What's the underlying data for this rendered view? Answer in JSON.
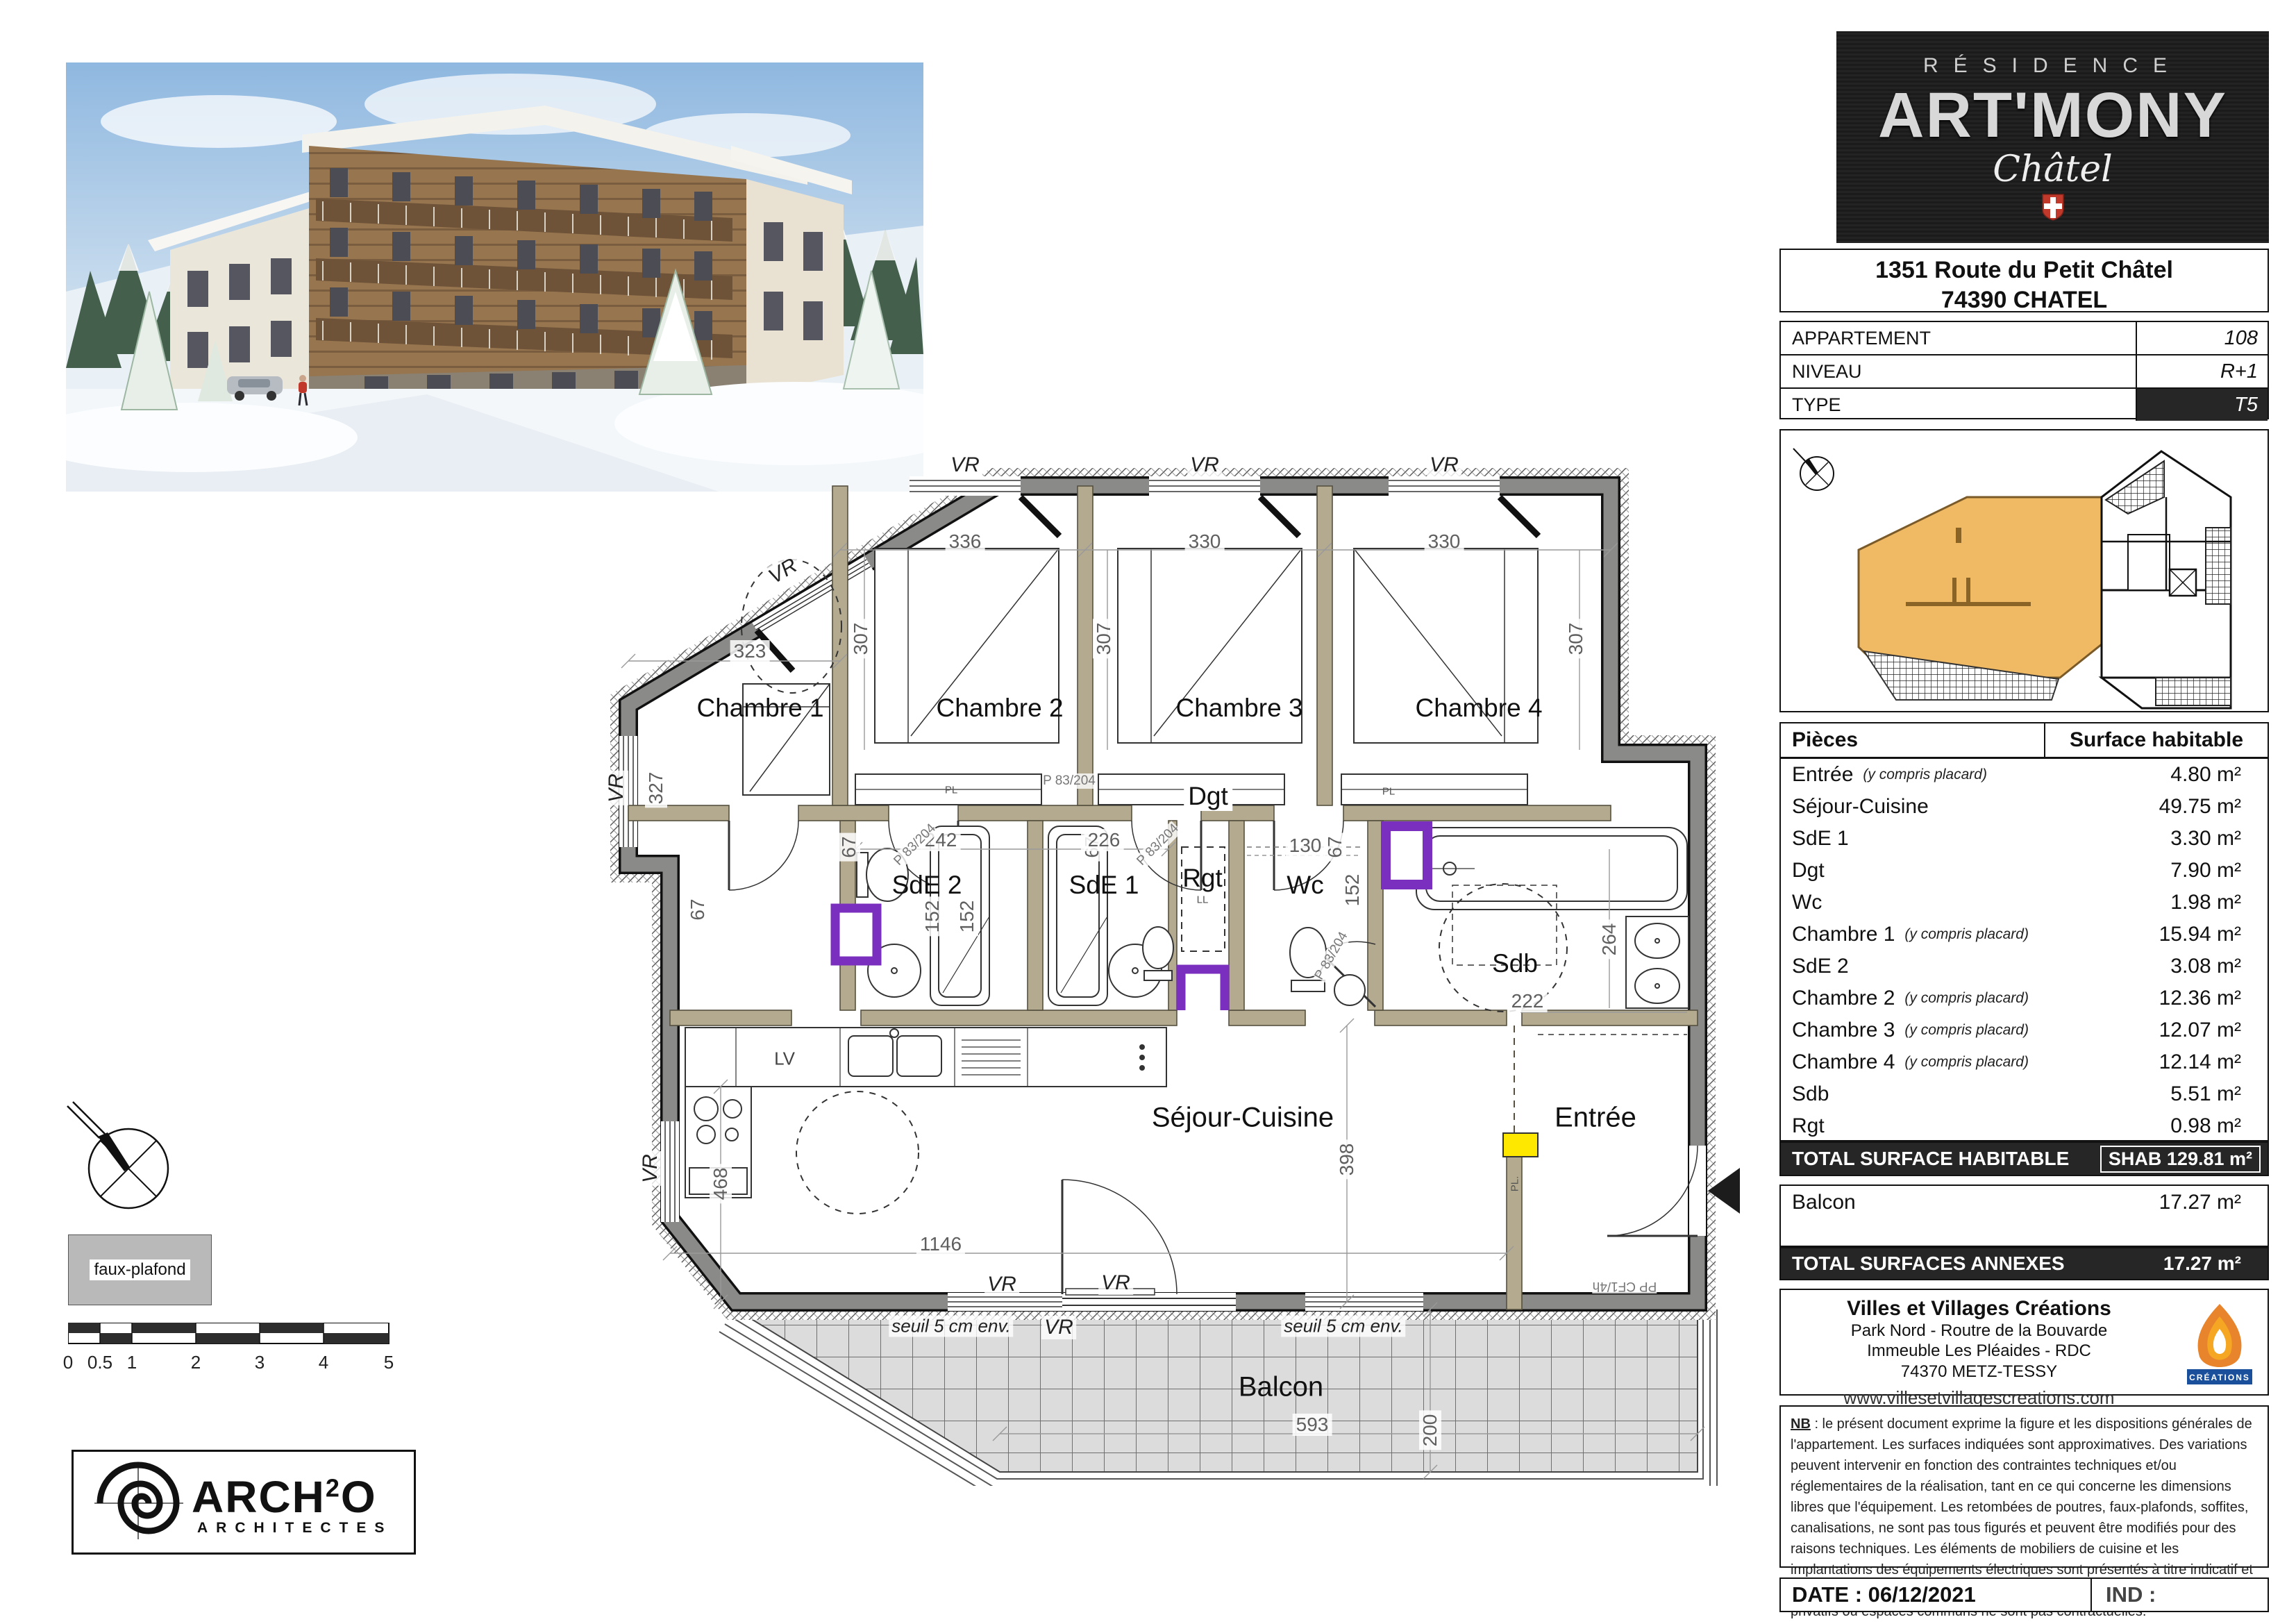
{
  "logo": {
    "residence": "RÉSIDENCE",
    "name": "ART'MONY",
    "place": "Châtel"
  },
  "address": {
    "line1": "1351 Route du Petit Châtel",
    "line2": "74390 CHATEL"
  },
  "info": {
    "rows": [
      {
        "label": "APPARTEMENT",
        "value": "108"
      },
      {
        "label": "NIVEAU",
        "value": "R+1"
      },
      {
        "label": "TYPE",
        "value": "T5"
      }
    ]
  },
  "surfaces": {
    "header": {
      "pieces": "Pièces",
      "surface": "Surface habitable"
    },
    "rows": [
      {
        "name": "Entrée",
        "note": "(y compris placard)",
        "value": "4.80 m²"
      },
      {
        "name": "Séjour-Cuisine",
        "note": "",
        "value": "49.75 m²"
      },
      {
        "name": "SdE 1",
        "note": "",
        "value": "3.30 m²"
      },
      {
        "name": "Dgt",
        "note": "",
        "value": "7.90 m²"
      },
      {
        "name": "Wc",
        "note": "",
        "value": "1.98 m²"
      },
      {
        "name": "Chambre 1",
        "note": "(y compris placard)",
        "value": "15.94 m²"
      },
      {
        "name": "SdE 2",
        "note": "",
        "value": "3.08 m²"
      },
      {
        "name": "Chambre 2",
        "note": "(y compris placard)",
        "value": "12.36 m²"
      },
      {
        "name": "Chambre 3",
        "note": "(y compris placard)",
        "value": "12.07 m²"
      },
      {
        "name": "Chambre 4",
        "note": "(y compris placard)",
        "value": "12.14 m²"
      },
      {
        "name": "Sdb",
        "note": "",
        "value": "5.51 m²"
      },
      {
        "name": "Rgt",
        "note": "",
        "value": "0.98 m²"
      }
    ],
    "total_label": "TOTAL SURFACE HABITABLE",
    "total_value": "SHAB 129.81 m²",
    "annex_row": {
      "name": "Balcon",
      "value": "17.27 m²"
    },
    "annex_total_label": "TOTAL SURFACES ANNEXES",
    "annex_total_value": "17.27 m²"
  },
  "company": {
    "name": "Villes et Villages Créations",
    "line1": "Park Nord - Routre de la Bouvarde",
    "line2": "Immeuble Les Pléaides - RDC",
    "line3": "74370 METZ-TESSY",
    "url": "www.villesetvillagescreations.com",
    "logo_caption": "CRÉATIONS"
  },
  "note": {
    "nb": "NB",
    "rest": " : le présent document exprime la figure et les dispositions générales de l'appartement. Les surfaces indiquées sont approximatives. Des variations peuvent intervenir en fonction des contraintes techniques et/ou réglementaires de la réalisation, tant en ce qui concerne les dimensions libres que l'équipement. Les retombées de poutres, faux-plafonds, soffites, canalisations, ne sont pas tous figurés et peuvent être modifiés pour des raisons techniques. Les éléments de mobiliers de cuisine et les implantations des équipements électriques sont présentés à titre indicatif et ne sont pas contractuels. Les éventuelles plantations dans les jardins privatifs ou espaces communs ne sont pas contractuelles."
  },
  "footer": {
    "date": "DATE : 06/12/2021",
    "ind": "IND :"
  },
  "legend": {
    "faux_plafond": "faux-plafond",
    "ticks": [
      "0",
      "0.5",
      "1",
      "2",
      "3",
      "4",
      "5"
    ]
  },
  "architect": {
    "arch": "ARCH",
    "sup": "2",
    "o": "O",
    "subtitle": "ARCHITECTES"
  },
  "plan": {
    "rooms": {
      "chambre1": "Chambre 1",
      "chambre2": "Chambre 2",
      "chambre3": "Chambre 3",
      "chambre4": "Chambre 4",
      "sde1": "SdE 1",
      "sde2": "SdE 2",
      "dgt": "Dgt",
      "rgt": "Rgt",
      "wc": "Wc",
      "sdb": "Sdb",
      "sejour": "Séjour-Cuisine",
      "entree": "Entrée",
      "balcon": "Balcon"
    },
    "dims": {
      "d336": "336",
      "d330": "330",
      "d323": "323",
      "d327": "327",
      "d307": "307",
      "d67": "67",
      "d242": "242",
      "d226": "226",
      "d152": "152",
      "d130": "130",
      "d222": "222",
      "d264": "264",
      "d468": "468",
      "d398": "398",
      "d1146": "1146",
      "d200": "200",
      "d593": "593"
    },
    "annot": {
      "vr": "VR",
      "p83": "P 83/204",
      "pp": "PP CF1/4h",
      "seuil": "seuil 5 cm env.",
      "lv": "LV",
      "ll": "LL",
      "pl": "PL.",
      "pl2": "PL"
    },
    "colors": {
      "purple": "#7b2fbe",
      "yellow": "#ffe800",
      "unit_orange": "#f0b963",
      "wall_gray": "#8a8a88"
    }
  }
}
